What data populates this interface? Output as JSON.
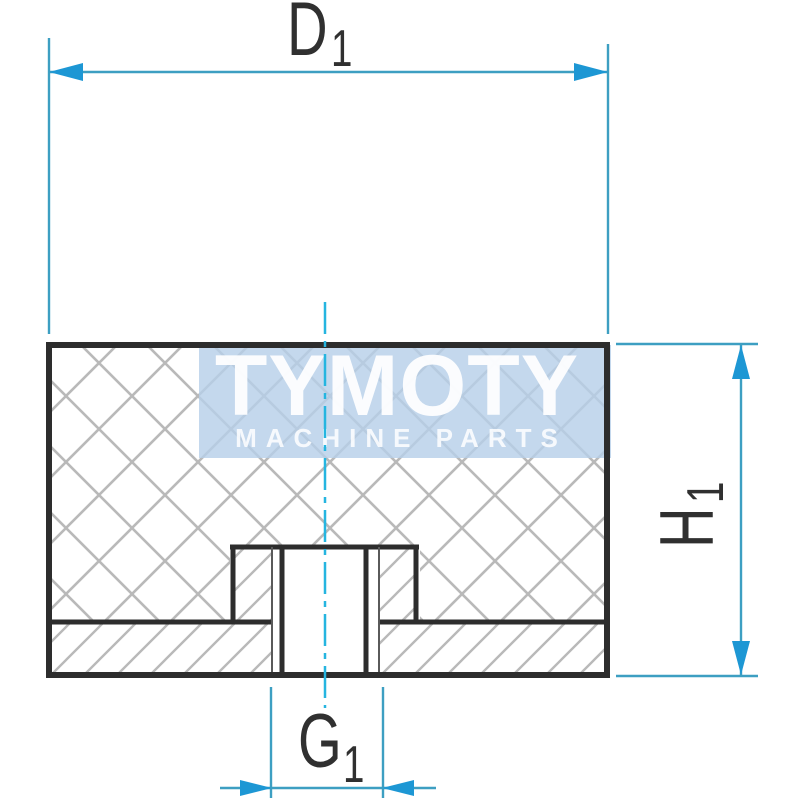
{
  "drawing": {
    "kind": "cross-section of cylindrical rubber buffer with internal threaded insert",
    "labels": {
      "diameter": {
        "letter": "D",
        "sub": "1"
      },
      "height": {
        "letter": "H",
        "sub": "1"
      },
      "thread": {
        "letter": "G",
        "sub": "1"
      }
    },
    "watermark": {
      "title": "TYMOTY",
      "subtitle": "MACHINE PARTS"
    },
    "colors": {
      "outline": "#2d2d2d",
      "thin_thread_line": "#5a5a5a",
      "hatch": "#b9b9b9",
      "dimension_line": "#3d9fc2",
      "dimension_arrow": "#1d97d4",
      "centerline": "#25b5e0",
      "watermark_bg": "#b7cfe8",
      "label_text": "#303030"
    }
  }
}
